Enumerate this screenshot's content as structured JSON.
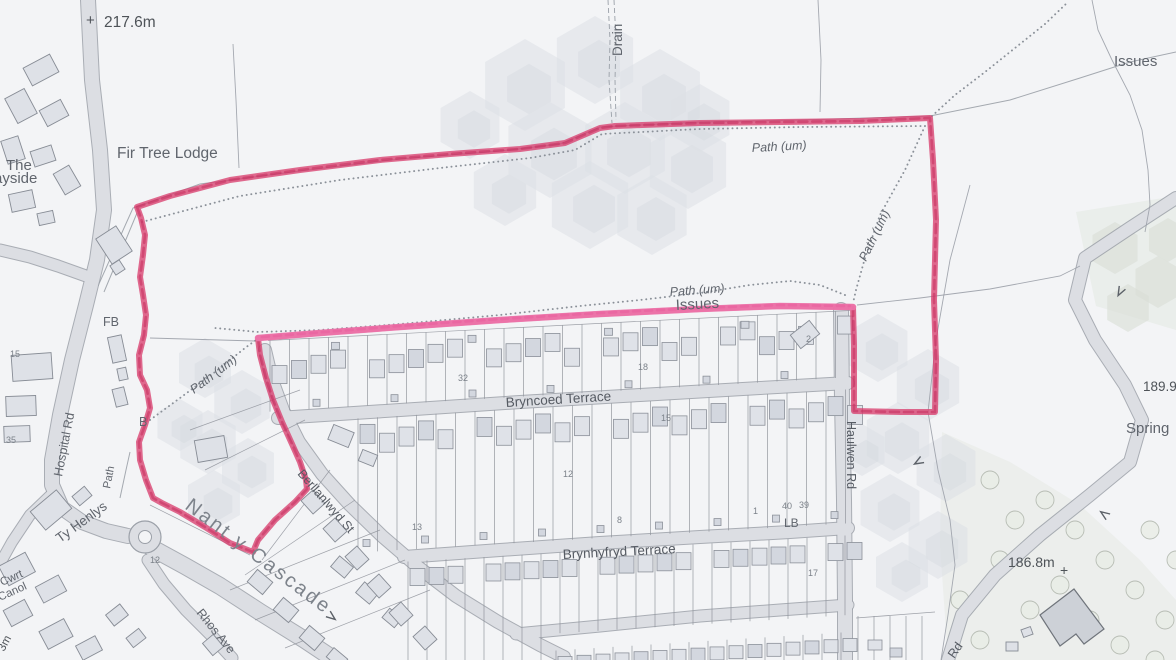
{
  "colors": {
    "background": "#f3f4f6",
    "road_fill": "#dcdee3",
    "road_casing": "#9ba0a8",
    "boundary_red": "#d84070",
    "boundary_pink": "#ee74ac",
    "label_grey": "#60656d"
  },
  "map": {
    "labels": {
      "plus_217": {
        "text": "+"
      },
      "spot_217": {
        "text": "217.6m"
      },
      "fir_tree_lodge": {
        "text": "Fir Tree Lodge"
      },
      "the_partial": {
        "text": "The"
      },
      "wayside_partial": {
        "text": "ayside"
      },
      "drain": {
        "text": "Drain"
      },
      "issues_top_right": {
        "text": "Issues"
      },
      "path_um_top": {
        "text": "Path (um)"
      },
      "path_um_right": {
        "text": "Path (um)"
      },
      "path_um_mid": {
        "text": "Path (um)"
      },
      "issues_mid": {
        "text": "Issues"
      },
      "path_um_left": {
        "text": "Path (um)"
      },
      "fb": {
        "text": "FB"
      },
      "b_small": {
        "text": "B"
      },
      "hospital_rd": {
        "text": "Hospital Rd"
      },
      "path_small": {
        "text": "Path"
      },
      "ty_henlys": {
        "text": "Ty Henlys"
      },
      "nant_y_cascade": {
        "text": "Nant y Cascade"
      },
      "rhos_ave": {
        "text": "Rhos Ave"
      },
      "cwrt_partial": {
        "text": "Cwrt"
      },
      "canol_partial": {
        "text": "Canol"
      },
      "spot_3m": {
        "text": "3m"
      },
      "berllanlwyd_st": {
        "text": "Berllanlwyd St"
      },
      "bryncoed_terrace": {
        "text": "Bryncoed Terrace"
      },
      "brynhyfryd_terrace": {
        "text": "Brynhyfryd Terrace"
      },
      "haulwen_rd": {
        "text": "Haulwen Rd"
      },
      "lb": {
        "text": "LB"
      },
      "spot_189": {
        "text": "189.9"
      },
      "spring": {
        "text": "Spring"
      },
      "spot_186": {
        "text": "186.8m"
      },
      "plus_186": {
        "text": "+"
      },
      "rd_partial": {
        "text": "Rd"
      }
    },
    "house_numbers": [
      {
        "text": "32",
        "x": 458,
        "y": 381
      },
      {
        "text": "18",
        "x": 638,
        "y": 370
      },
      {
        "text": "15",
        "x": 661,
        "y": 421
      },
      {
        "text": "2",
        "x": 806,
        "y": 342
      },
      {
        "text": "13",
        "x": 412,
        "y": 530
      },
      {
        "text": "8",
        "x": 617,
        "y": 523
      },
      {
        "text": "1",
        "x": 753,
        "y": 514
      },
      {
        "text": "40",
        "x": 782,
        "y": 509
      },
      {
        "text": "39",
        "x": 799,
        "y": 508
      },
      {
        "text": "17",
        "x": 808,
        "y": 576
      },
      {
        "text": "12",
        "x": 563,
        "y": 477
      },
      {
        "text": "12",
        "x": 150,
        "y": 563
      },
      {
        "text": "35",
        "x": 6,
        "y": 443
      },
      {
        "text": "15",
        "x": 10,
        "y": 357
      }
    ]
  }
}
